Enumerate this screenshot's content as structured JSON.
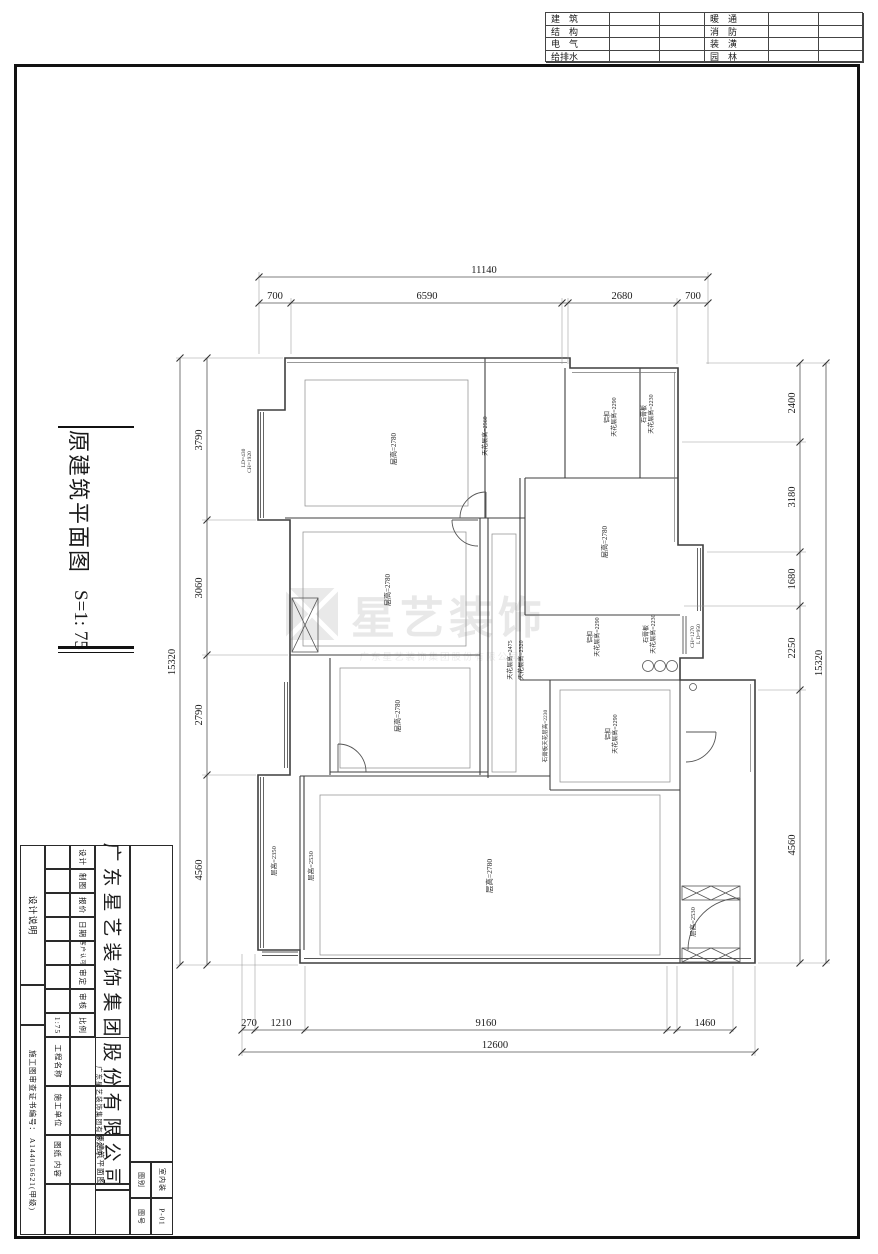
{
  "disciplines_table": {
    "rows": [
      [
        "建　筑",
        "暖　通"
      ],
      [
        "结　构",
        "消　防"
      ],
      [
        "电　气",
        "装　潢"
      ],
      [
        "给排水",
        "园　林"
      ]
    ]
  },
  "sheet_title": {
    "name": "原建筑平面图",
    "scale": "S=1: 75"
  },
  "watermark": {
    "brand": "星艺装饰",
    "sub": "广东星艺装饰集团股份有限公司"
  },
  "dimensions": {
    "top": {
      "overall": "11140",
      "segments": [
        "700",
        "6590",
        "2680",
        "700"
      ]
    },
    "left": {
      "overall": "15320",
      "segments": [
        "3790",
        "3060",
        "2790",
        "4560"
      ]
    },
    "right": {
      "overall": "15320",
      "segments": [
        "2400",
        "3180",
        "1680",
        "2250",
        "4560"
      ]
    },
    "bottom": {
      "overall": "12600",
      "segments": [
        "270",
        "1210",
        "9160",
        "1460"
      ]
    }
  },
  "room_labels": [
    {
      "text": "层高=2780",
      "x": 396,
      "y": 449,
      "size": 7
    },
    {
      "text": "天花层高=2560",
      "x": 487,
      "y": 436,
      "size": 6
    },
    {
      "text": "LD=430",
      "x": 245,
      "y": 458,
      "size": 5.5
    },
    {
      "text": "CH=1920",
      "x": 251,
      "y": 462,
      "size": 5.5
    },
    {
      "text": "铝扣",
      "x": 609,
      "y": 417,
      "size": 6
    },
    {
      "text": "天花层高=2290",
      "x": 616,
      "y": 417,
      "size": 6
    },
    {
      "text": "石膏板",
      "x": 646,
      "y": 414,
      "size": 6
    },
    {
      "text": "天花层高=2230",
      "x": 653,
      "y": 414,
      "size": 6
    },
    {
      "text": "层高=2780",
      "x": 607,
      "y": 542,
      "size": 7
    },
    {
      "text": "天花层高=2475",
      "x": 512,
      "y": 660,
      "size": 6
    },
    {
      "text": "天花层高=2320",
      "x": 523,
      "y": 660,
      "size": 6
    },
    {
      "text": "层高=2780",
      "x": 390,
      "y": 590,
      "size": 7
    },
    {
      "text": "层高=2780",
      "x": 400,
      "y": 716,
      "size": 7
    },
    {
      "text": "铝扣",
      "x": 592,
      "y": 637,
      "size": 6
    },
    {
      "text": "天花层高=2290",
      "x": 599,
      "y": 637,
      "size": 6
    },
    {
      "text": "石膏板",
      "x": 648,
      "y": 634,
      "size": 6
    },
    {
      "text": "天花层高=2230",
      "x": 655,
      "y": 634,
      "size": 6
    },
    {
      "text": "CH=1270",
      "x": 694,
      "y": 637,
      "size": 5.5
    },
    {
      "text": "L D=950",
      "x": 700,
      "y": 634,
      "size": 5.5
    },
    {
      "text": "石膏板天花层高=2230",
      "x": 547,
      "y": 736,
      "size": 5.5
    },
    {
      "text": "铝扣",
      "x": 610,
      "y": 734,
      "size": 6
    },
    {
      "text": "天花层高=2290",
      "x": 617,
      "y": 734,
      "size": 6
    },
    {
      "text": "层高=2780",
      "x": 492,
      "y": 876,
      "size": 7.5
    },
    {
      "text": "层高=2350",
      "x": 276,
      "y": 861,
      "size": 6.5
    },
    {
      "text": "层高=2530",
      "x": 313,
      "y": 866,
      "size": 6.5
    },
    {
      "text": "层高=2530",
      "x": 695,
      "y": 922,
      "size": 6.5
    }
  ],
  "title_block": {
    "labels_col": [
      "设计",
      "制图",
      "报价",
      "日期",
      "客户认可",
      "审定",
      "审核",
      "比例"
    ],
    "scale_value": "1:75",
    "company": "广东星艺装饰集团股份有限公司",
    "project_label": "工程名称",
    "builder_label": "施工单位",
    "builder_value": "广东星艺装饰集团有限公司",
    "drawing_label": "图纸 内容",
    "drawing_value": "原建筑平面图",
    "type_label": "图别",
    "type_value": "室内装",
    "no_label": "图号",
    "no_value": "P-01",
    "side_top": "设计说明",
    "side_bottom": "施工图审查证书编号：  A144016621(甲级)"
  }
}
